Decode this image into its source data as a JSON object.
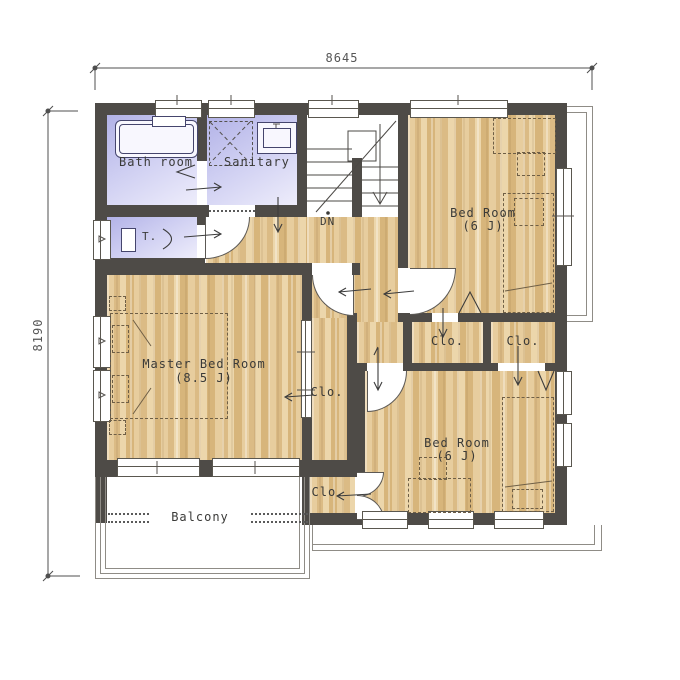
{
  "dimensions": {
    "width_mm": "8645",
    "height_mm": "8190"
  },
  "rooms": {
    "bath": {
      "label": "Bath room"
    },
    "sanitary": {
      "label": "Sanitary"
    },
    "toilet": {
      "label": "T."
    },
    "stairs": {
      "down_label": "DN"
    },
    "bedroom_top_right": {
      "label": "Bed Room",
      "size": "(6 J)"
    },
    "master_bedroom": {
      "label": "Master Bed Room",
      "size": "(8.5 J)"
    },
    "bedroom_bottom_right": {
      "label": "Bed Room",
      "size": "(6 J)"
    },
    "balcony": {
      "label": "Balcony"
    }
  },
  "closets": {
    "master": {
      "label": "Clo."
    },
    "upper_left": {
      "label": "Clo."
    },
    "upper_right": {
      "label": "Clo."
    },
    "lower": {
      "label": "Clo."
    }
  },
  "colors": {
    "wall": "#4e4b47",
    "wood_light": "#ecd6ab",
    "wood_dark": "#d7b57b",
    "wet_room": "#b2b2e7",
    "line": "#5a574f",
    "dimension_text": "#565656"
  }
}
